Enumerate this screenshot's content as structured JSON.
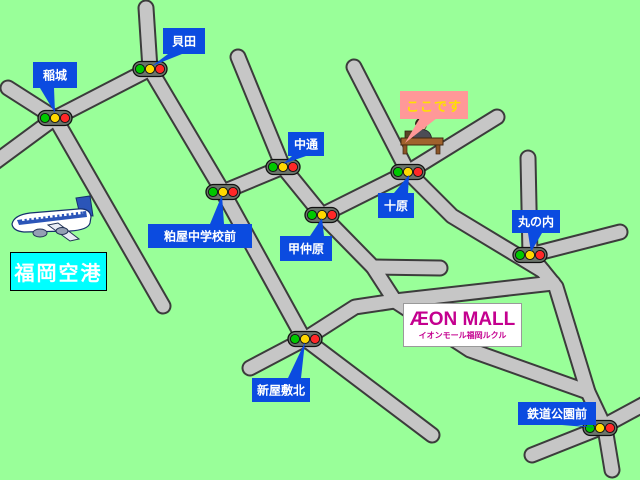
{
  "map": {
    "colors": {
      "background": "#99FF99",
      "road_fill": "#C6C6C6",
      "road_outline": "#3C3C3C",
      "label_bg": "#0B4BE0",
      "label_text": "#FFFFFF",
      "light_body": "#6B756B",
      "light_outline": "#111111",
      "light_green": "#00C800",
      "light_yellow": "#FFD800",
      "light_red": "#FF2828"
    },
    "roads": [
      [
        [
          8,
          88
        ],
        [
          55,
          118
        ]
      ],
      [
        [
          55,
          118
        ],
        [
          -6,
          163
        ]
      ],
      [
        [
          55,
          118
        ],
        [
          150,
          69
        ]
      ],
      [
        [
          150,
          69
        ],
        [
          146,
          8
        ]
      ],
      [
        [
          150,
          69
        ],
        [
          223,
          192
        ],
        [
          305,
          341
        ]
      ],
      [
        [
          55,
          118
        ],
        [
          163,
          306
        ]
      ],
      [
        [
          223,
          192
        ],
        [
          283,
          167
        ]
      ],
      [
        [
          283,
          167
        ],
        [
          238,
          57
        ]
      ],
      [
        [
          283,
          167
        ],
        [
          322,
          215
        ]
      ],
      [
        [
          322,
          215
        ],
        [
          408,
          172
        ],
        [
          497,
          117
        ]
      ],
      [
        [
          408,
          172
        ],
        [
          354,
          67
        ]
      ],
      [
        [
          408,
          172
        ],
        [
          452,
          216
        ],
        [
          543,
          271
        ]
      ],
      [
        [
          528,
          158
        ],
        [
          530,
          255
        ]
      ],
      [
        [
          530,
          255
        ],
        [
          620,
          232
        ]
      ],
      [
        [
          530,
          255
        ],
        [
          556,
          287
        ],
        [
          588,
          392
        ],
        [
          605,
          428
        ],
        [
          612,
          470
        ]
      ],
      [
        [
          532,
          455
        ],
        [
          600,
          428
        ],
        [
          648,
          402
        ]
      ],
      [
        [
          305,
          339
        ],
        [
          355,
          307
        ],
        [
          395,
          301
        ]
      ],
      [
        [
          395,
          301
        ],
        [
          553,
          283
        ]
      ],
      [
        [
          395,
          301
        ],
        [
          470,
          350
        ],
        [
          588,
          392
        ]
      ],
      [
        [
          322,
          215
        ],
        [
          373,
          267
        ]
      ],
      [
        [
          373,
          267
        ],
        [
          440,
          268
        ]
      ],
      [
        [
          373,
          267
        ],
        [
          395,
          301
        ]
      ],
      [
        [
          305,
          339
        ],
        [
          250,
          368
        ]
      ],
      [
        [
          305,
          339
        ],
        [
          432,
          435
        ]
      ]
    ],
    "traffic_lights": [
      {
        "id": "inagi",
        "x": 55,
        "y": 118
      },
      {
        "id": "kaida",
        "x": 150,
        "y": 69
      },
      {
        "id": "kasuya-chugakko-mae",
        "x": 223,
        "y": 192
      },
      {
        "id": "nakadori",
        "x": 283,
        "y": 167
      },
      {
        "id": "konakahara",
        "x": 322,
        "y": 215
      },
      {
        "id": "juhara",
        "x": 408,
        "y": 172
      },
      {
        "id": "marunouchi",
        "x": 530,
        "y": 255
      },
      {
        "id": "shin-yashiki-kita",
        "x": 305,
        "y": 339
      },
      {
        "id": "tetsudo-koen-mae",
        "x": 600,
        "y": 428
      }
    ],
    "labels": [
      {
        "id": "inagi",
        "text": "稲城",
        "box": [
          33,
          62,
          44,
          26
        ],
        "tail": [
          [
            40,
            88
          ],
          [
            54,
            88
          ],
          [
            55,
            113
          ]
        ]
      },
      {
        "id": "kaida",
        "text": "貝田",
        "box": [
          163,
          28,
          42,
          26
        ],
        "tail": [
          [
            168,
            54
          ],
          [
            182,
            54
          ],
          [
            152,
            66
          ]
        ]
      },
      {
        "id": "nakadori",
        "text": "中通",
        "box": [
          288,
          132,
          36,
          24
        ],
        "tail": [
          [
            292,
            156
          ],
          [
            306,
            156
          ],
          [
            283,
            164
          ]
        ]
      },
      {
        "id": "juhara",
        "text": "十原",
        "box": [
          378,
          193,
          36,
          25
        ],
        "tail": [
          [
            394,
            193
          ],
          [
            408,
            193
          ],
          [
            409,
            175
          ]
        ]
      },
      {
        "id": "marunouchi",
        "text": "丸の内",
        "box": [
          512,
          210,
          48,
          23
        ],
        "tail": [
          [
            528,
            233
          ],
          [
            542,
            233
          ],
          [
            531,
            252
          ]
        ]
      },
      {
        "id": "konakahara",
        "text": "甲仲原",
        "box": [
          280,
          236,
          52,
          25
        ],
        "tail": [
          [
            310,
            236
          ],
          [
            324,
            236
          ],
          [
            322,
            218
          ]
        ]
      },
      {
        "id": "kasuya-chugakko-mae",
        "text": "粕屋中学校前",
        "box": [
          148,
          224,
          104,
          24
        ],
        "tail": [
          [
            210,
            224
          ],
          [
            224,
            224
          ],
          [
            222,
            195
          ]
        ]
      },
      {
        "id": "shin-yashiki-kita",
        "text": "新屋敷北",
        "box": [
          252,
          378,
          58,
          24
        ],
        "tail": [
          [
            288,
            378
          ],
          [
            301,
            378
          ],
          [
            305,
            342
          ]
        ]
      },
      {
        "id": "tetsudo-koen-mae",
        "text": "鉄道公園前",
        "box": [
          518,
          402,
          78,
          23
        ],
        "tail": [
          [
            562,
            425
          ],
          [
            577,
            425
          ],
          [
            598,
            428
          ]
        ]
      }
    ],
    "here": {
      "text": "ここです",
      "bg": "#FF9898",
      "color": "#FFE000",
      "box": [
        400,
        91,
        68,
        28
      ],
      "tail": [
        [
          420,
          118
        ],
        [
          437,
          118
        ],
        [
          405,
          143
        ]
      ]
    },
    "airport": {
      "text": "福岡空港",
      "bg": "#00FFFF",
      "box": [
        10,
        252,
        97,
        39
      ]
    },
    "aeon": {
      "title": "ÆON MALL",
      "subtitle": "イオンモール福岡ルクル",
      "color": "#C4008F",
      "box": [
        403,
        303,
        119,
        44
      ]
    }
  }
}
